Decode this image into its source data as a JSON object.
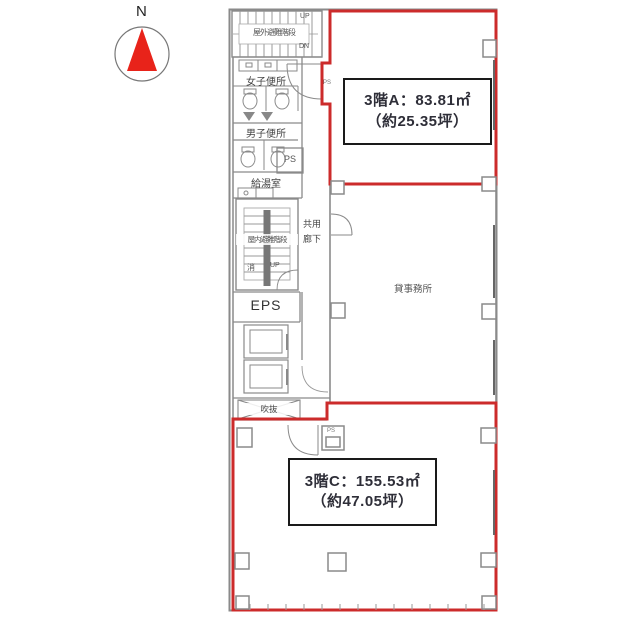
{
  "compass": {
    "label": "N"
  },
  "colors": {
    "boundary_red": "#cc2b2b",
    "wall_gray": "#8a8a8a",
    "compass_red": "#e8231a",
    "text_dark": "#2e2e38"
  },
  "labels": {
    "outdoor_stair": "屋外避難階段",
    "outdoor_stair_up": "UP",
    "outdoor_stair_dn": "DN",
    "womens_toilet": "女子便所",
    "mens_toilet": "男子便所",
    "ps_upper": "PS",
    "ps_tiny_a": "PS",
    "ps_tiny_c": "PS",
    "kitchenette": "給湯室",
    "indoor_stair": "屋内避難階段",
    "indoor_stair_fire": "消",
    "indoor_stair_up": "UP",
    "corridor_line1": "共用",
    "corridor_line2": "廊下",
    "eps": "EPS",
    "void": "吹抜",
    "office": "貸事務所"
  },
  "units": {
    "a": {
      "area_line": "3階A：83.81㎡",
      "tsubo_line": "（約25.35坪）"
    },
    "c": {
      "area_line": "3階C：155.53㎡",
      "tsubo_line": "（約47.05坪）"
    }
  }
}
